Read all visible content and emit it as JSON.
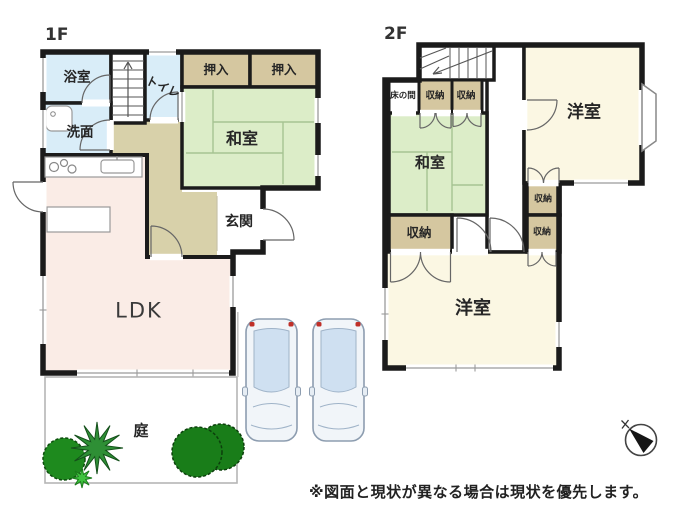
{
  "image_type": "real-estate floor plan",
  "floors": [
    {
      "label": "1F",
      "rooms": {
        "bathroom": "浴室",
        "washroom": "洗面",
        "toilet": "トイレ",
        "closet_left": "押入",
        "closet_right": "押入",
        "japanese_room": "和室",
        "entrance": "玄関",
        "ldk": "LDK",
        "garden": "庭"
      }
    },
    {
      "label": "2F",
      "rooms": {
        "tokonoma": "床の間",
        "storage_top_left": "収納",
        "storage_top_right": "収納",
        "japanese_room": "和室",
        "western_room_upper": "洋室",
        "storage_left": "収納",
        "storage_right_upper": "収納",
        "storage_right_lower": "収納",
        "western_room_lower": "洋室"
      }
    }
  ],
  "note": "※図面と現状が異なる場合は現状を優先します。",
  "colors": {
    "wall": "#1b1b1b",
    "water_rooms_blue": "#d9edf8",
    "closet_tan": "#d5c7a0",
    "tatami_green": "#dcedc8",
    "hallway_khaki": "#d8d1aa",
    "ldk_pink": "#faece6",
    "western_room_cream": "#fbf7e3",
    "tree_green": "#1e7d19",
    "car_glass_blue": "#cfe0f1",
    "tail_light_red": "#c03028"
  }
}
